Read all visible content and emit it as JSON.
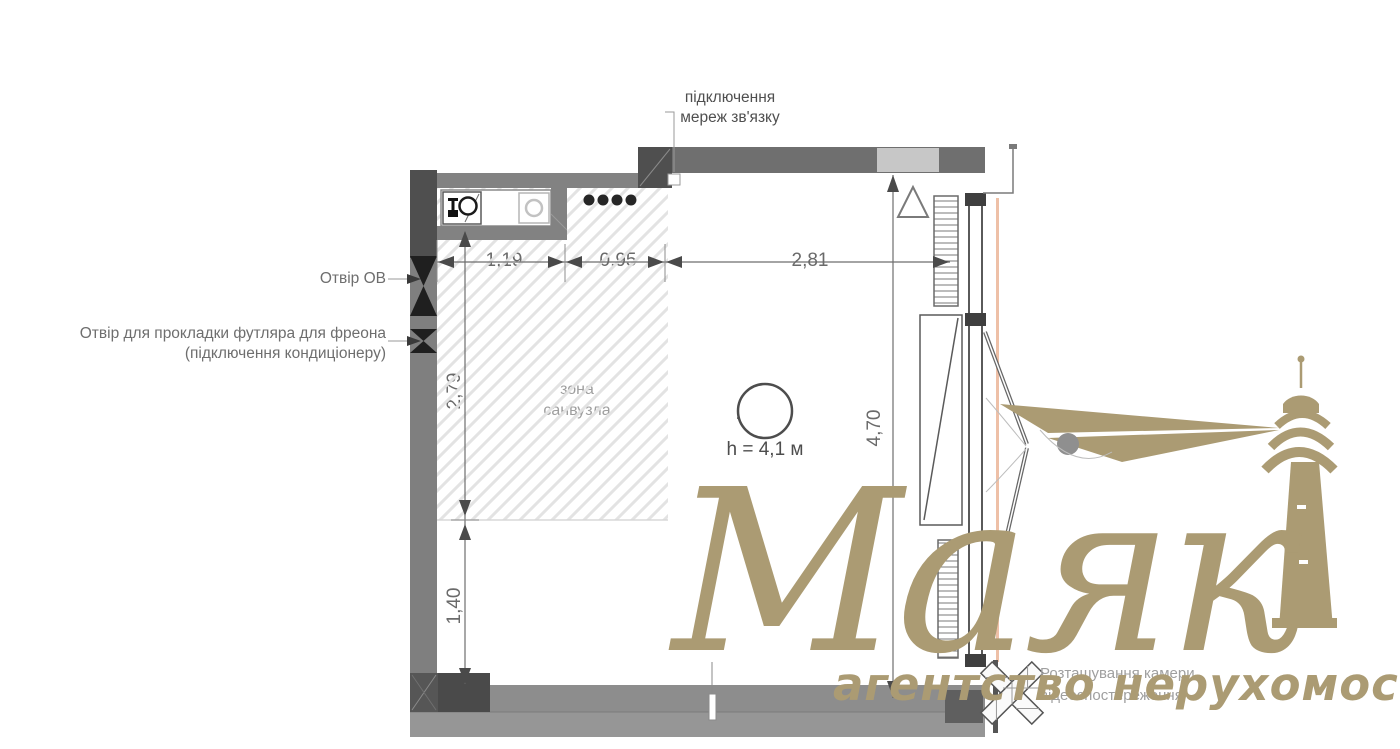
{
  "unit": {
    "number": "1005",
    "ceiling_height": "h = 4,1 м"
  },
  "labels": {
    "comms_line1": "підключення",
    "comms_line2": "мереж зв'язку",
    "otvir_ov": "Отвір ОВ",
    "freon_line1": "Отвір для прокладки футляра для фреона",
    "freon_line2": "(підключення кондиціонеру)",
    "zone_line1": "зона",
    "zone_line2": "санвузла",
    "camera_line1": "Розташування камери",
    "camera_line2": "відеоспостереження"
  },
  "dimensions": {
    "top_1": "1,19",
    "top_2": "0,95",
    "top_3": "2,81",
    "left_1": "2,79",
    "left_2": "1,40",
    "right_1": "4,70"
  },
  "watermark": {
    "brand": "Маяк",
    "tagline": "агентство нерухомості",
    "color": "#ab9b73"
  },
  "colors": {
    "wall_mid": "#828282",
    "wall_dark": "#4f4f4f",
    "vent_shaft_light": "#c7c7c7",
    "facade_accent": "#eec0a7",
    "hatch": "#e3e3e3",
    "dimension_text": "#6a6a6a"
  }
}
